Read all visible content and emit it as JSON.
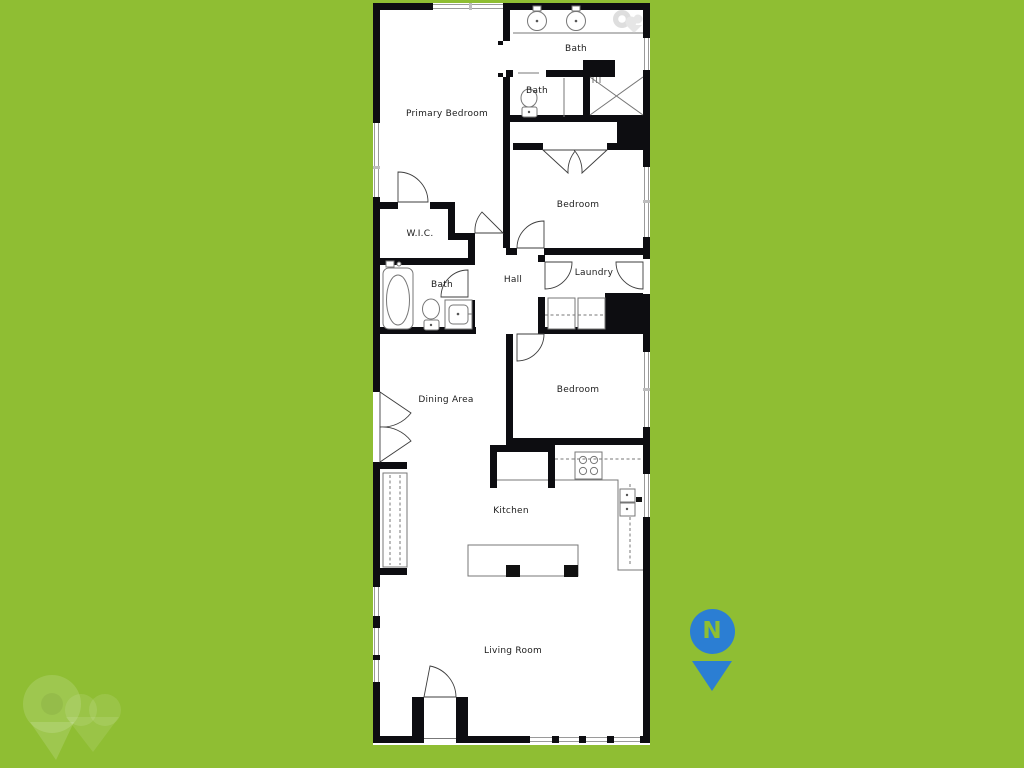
{
  "colors": {
    "background": "#8fbe33",
    "wall": "#0d0d11",
    "floor": "#ffffff",
    "compass_blue": "#2b7ed3"
  },
  "plan": {
    "rooms": [
      {
        "id": "primary_bedroom",
        "label": "Primary Bedroom"
      },
      {
        "id": "bath_ensuite",
        "label": "Bath"
      },
      {
        "id": "bath_small",
        "label": "Bath"
      },
      {
        "id": "bedroom_upper",
        "label": "Bedroom"
      },
      {
        "id": "wic",
        "label": "W.I.C."
      },
      {
        "id": "bath_hall",
        "label": "Bath"
      },
      {
        "id": "hall",
        "label": "Hall"
      },
      {
        "id": "laundry",
        "label": "Laundry"
      },
      {
        "id": "bedroom_lower",
        "label": "Bedroom"
      },
      {
        "id": "dining_area",
        "label": "Dining Area"
      },
      {
        "id": "kitchen",
        "label": "Kitchen"
      },
      {
        "id": "living_room",
        "label": "Living Room"
      }
    ]
  },
  "compass": {
    "label": "N"
  }
}
